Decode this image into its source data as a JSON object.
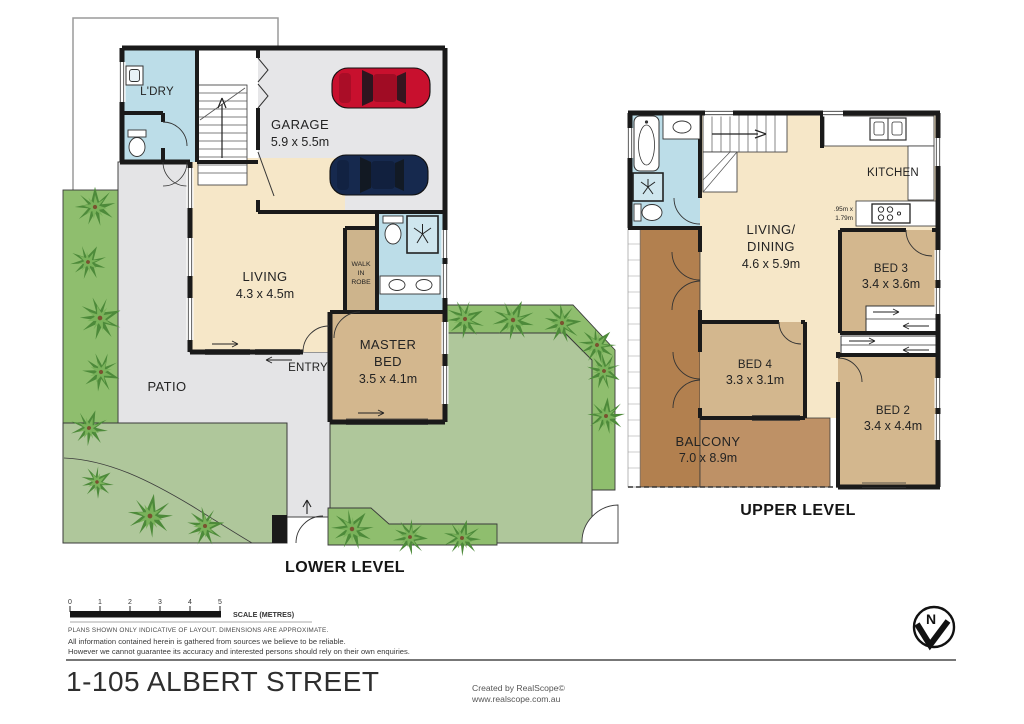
{
  "document": {
    "title": "1-105 ALBERT STREET",
    "credit_line1": "Created by RealScope©",
    "credit_line2": "www.realscope.com.au"
  },
  "lower_level": {
    "label": "LOWER LEVEL",
    "laundry": "L'DRY",
    "garage": {
      "name": "GARAGE",
      "dims": "5.9 x 5.5m"
    },
    "living": {
      "name": "LIVING",
      "dims": "4.3 x 4.5m"
    },
    "walk_in_robe": {
      "line1": "WALK",
      "line2": "IN",
      "line3": "ROBE"
    },
    "master_bed": {
      "line1": "MASTER",
      "line2": "BED",
      "dims": "3.5 x 4.1m"
    },
    "entry": "ENTRY",
    "patio": "PATIO"
  },
  "upper_level": {
    "label": "UPPER LEVEL",
    "kitchen": {
      "name": "KITCHEN",
      "bench_note_line1": ".95m x",
      "bench_note_line2": "1.79m"
    },
    "living_dining": {
      "line1": "LIVING/",
      "line2": "DINING",
      "dims": "4.6 x 5.9m"
    },
    "bed2": {
      "name": "BED 2",
      "dims": "3.4 x 4.4m"
    },
    "bed3": {
      "name": "BED 3",
      "dims": "3.4 x 3.6m"
    },
    "bed4": {
      "name": "BED 4",
      "dims": "3.3 x 3.1m"
    },
    "balcony": {
      "name": "BALCONY",
      "dims": "7.0 x 8.9m"
    }
  },
  "footer": {
    "scale_ticks": [
      "0",
      "1",
      "2",
      "3",
      "4",
      "5"
    ],
    "scale_label": "SCALE (METRES)",
    "disclaimer_line1": "PLANS SHOWN ONLY INDICATIVE OF LAYOUT.  DIMENSIONS ARE APPROXIMATE.",
    "disclaimer_line2": "All information contained herein is gathered from sources we believe to be reliable.",
    "disclaimer_line3": "However we cannot guarantee its accuracy and interested persons should rely on their own enquiries."
  },
  "compass": {
    "north_label": "N"
  },
  "colors": {
    "interior_cream": "#F6E7C8",
    "bedroom_tan": "#D3B78E",
    "wet_area_blue": "#BCDDE8",
    "hard_surface_grey": "#E4E4E6",
    "lawn_green": "#AFC79B",
    "garden_green": "#8FBE6E",
    "balcony_brown_dark": "#B2804F",
    "balcony_brown_light": "#BE9166",
    "wall_black": "#1A1A1A",
    "car_red": "#C8102E",
    "car_navy": "#16294E"
  }
}
